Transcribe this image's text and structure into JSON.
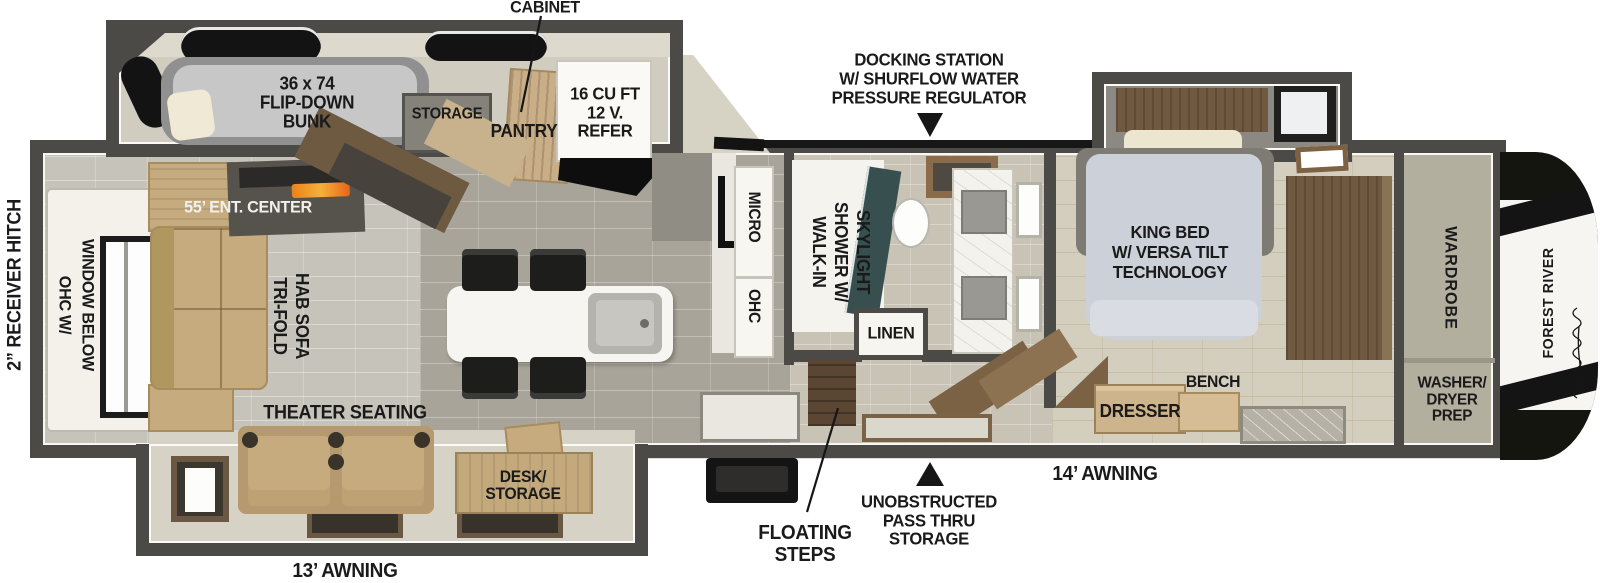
{
  "colors": {
    "wall": "#4b4a46",
    "accent_blue": "#2a6cb8",
    "fire_orange": "#e8821c",
    "label": "#1a1a1a"
  },
  "annotations": {
    "cabinet": "CABINET",
    "docking_station": [
      "DOCKING STATION",
      "W/ SHURFLOW WATER",
      "PRESSURE REGULATOR"
    ],
    "receiver_hitch": "2” RECEIVER HITCH",
    "awning_13": "13’ AWNING",
    "awning_14": "14’ AWNING",
    "floating_steps": [
      "FLOATING",
      "STEPS"
    ],
    "pass_thru_storage": [
      "UNOBSTRUCTED",
      "PASS THRU",
      "STORAGE"
    ]
  },
  "bunk_room": {
    "bunk": [
      "36 x 74",
      "FLIP-DOWN",
      "BUNK"
    ],
    "storage": "STORAGE",
    "pantry": "PANTRY",
    "refer": [
      "16 CU FT",
      "12 V.",
      "REFER"
    ]
  },
  "living": {
    "ent_center": "55’ ENT. CENTER",
    "ohc_window": [
      "OHC W/",
      "WINDOW BELOW"
    ],
    "sofa": [
      "TRI-FOLD",
      "HAB SOFA"
    ],
    "theater_seating": "THEATER SEATING",
    "desk_storage": [
      "DESK/",
      "STORAGE"
    ]
  },
  "kitchen": {
    "micro": "MICRO",
    "ohc": "OHC"
  },
  "bath": {
    "shower": [
      "WALK-IN",
      "SHOWER W/",
      "SKYLIGHT"
    ],
    "linen": "LINEN"
  },
  "bedroom": {
    "king_bed": [
      "KING BED",
      "W/ VERSA TILT",
      "TECHNOLOGY"
    ],
    "bench": "BENCH",
    "dresser": "DRESSER",
    "wardrobe": "WARDROBE",
    "washer_dryer": [
      "WASHER/",
      "DRYER",
      "PREP"
    ]
  },
  "brand": "FOREST RIVER"
}
